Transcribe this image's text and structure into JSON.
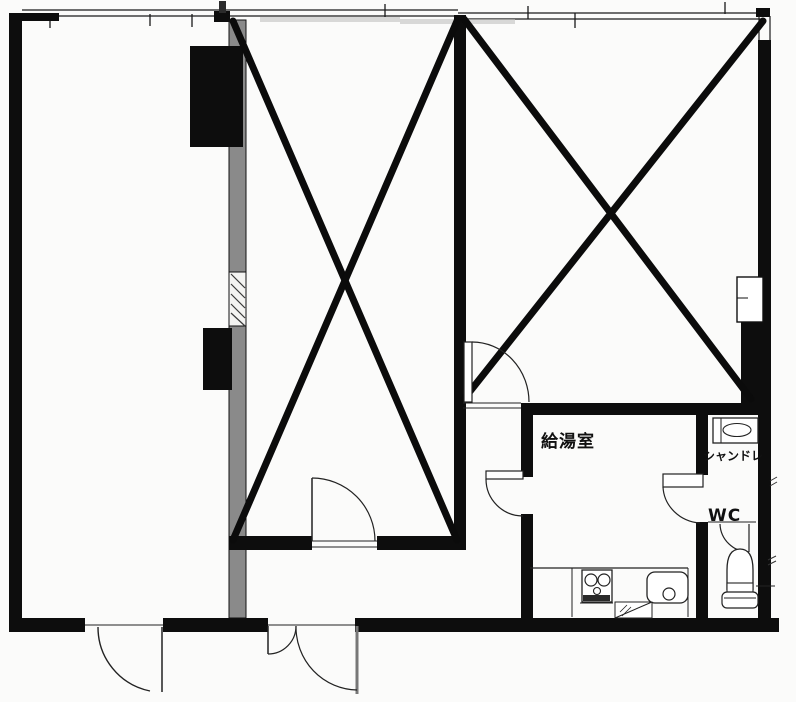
{
  "plan": {
    "type": "floor-plan",
    "rooms": {
      "kitchenette_label": "給湯室",
      "shampoo_dresser_label": "シャンドレ",
      "wc_label": "WC"
    },
    "crossed_out_areas": 2,
    "fixtures": [
      "shampoo-dresser-vanity",
      "two-burner-stove",
      "kitchen-sink",
      "toilet",
      "pipe-shaft-box"
    ],
    "door_symbols": 7,
    "colors": {
      "ink": "#111111",
      "paper": "#fbfbfa",
      "wall_fill_gray": "#8a8a8a",
      "pillar_black": "#0d0d0d"
    }
  }
}
